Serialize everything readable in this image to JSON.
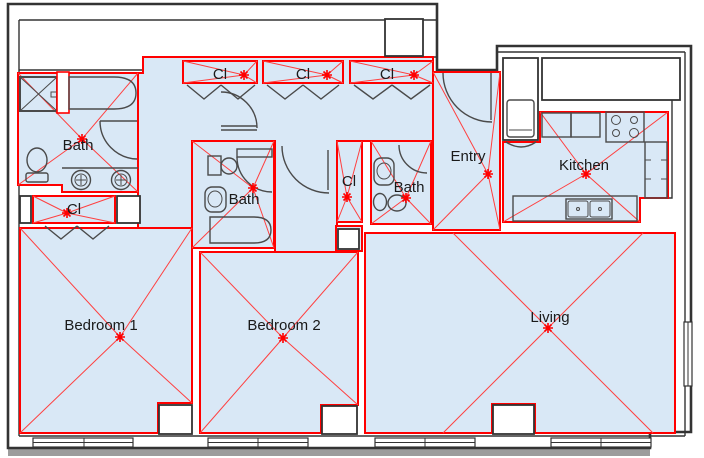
{
  "colors": {
    "room_fill": "#d9e8f6",
    "room_outline": "#ff0000",
    "cross_line": "#ff4040",
    "center_marker": "#ff0000",
    "wall": "#333333",
    "fixture": "#4a4a4a",
    "exterior_band": "#9c9c9c",
    "label_text": "#1a1a1a"
  },
  "rooms": [
    {
      "id": "bath-1",
      "label": "Bath"
    },
    {
      "id": "closet-vanity",
      "label": "Cl"
    },
    {
      "id": "closet-top-1",
      "label": "Cl"
    },
    {
      "id": "closet-top-2",
      "label": "Cl"
    },
    {
      "id": "closet-top-3",
      "label": "Cl"
    },
    {
      "id": "bath-2",
      "label": "Bath"
    },
    {
      "id": "closet-hall",
      "label": "Cl"
    },
    {
      "id": "bath-3",
      "label": "Bath"
    },
    {
      "id": "entry",
      "label": "Entry"
    },
    {
      "id": "kitchen",
      "label": "Kitchen"
    },
    {
      "id": "bedroom-1",
      "label": "Bedroom 1"
    },
    {
      "id": "bedroom-2",
      "label": "Bedroom 2"
    },
    {
      "id": "living",
      "label": "Living"
    }
  ]
}
